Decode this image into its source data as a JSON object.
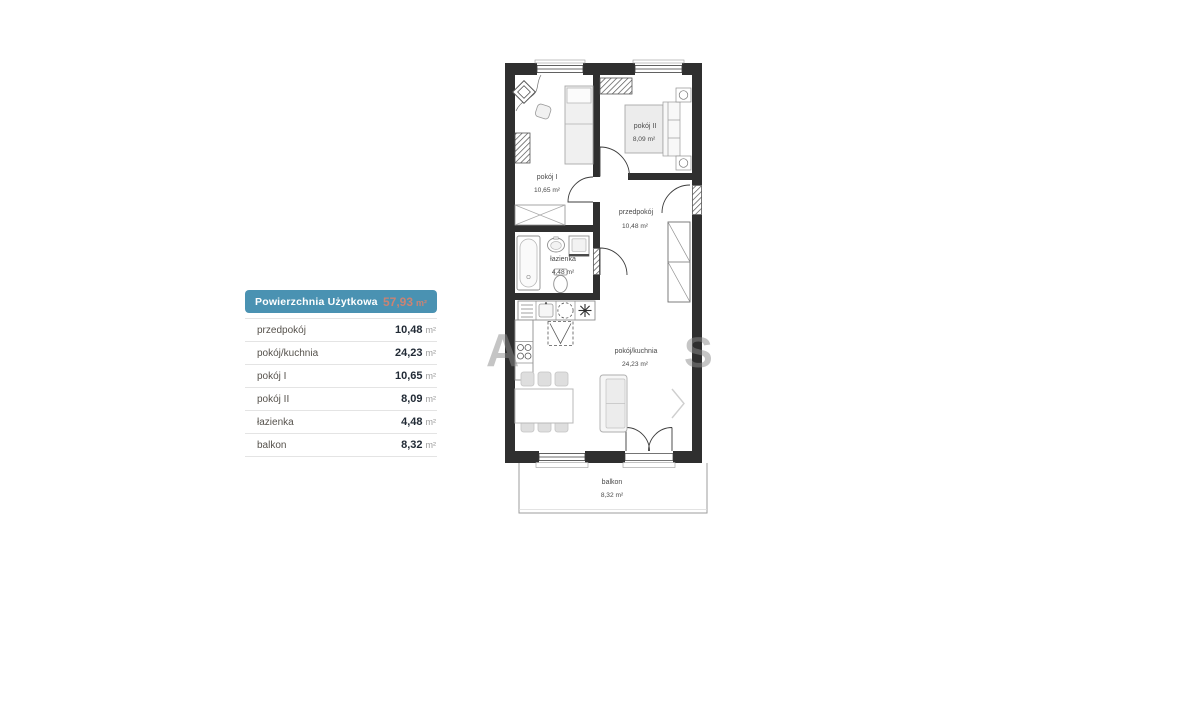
{
  "legend": {
    "title": "Powierzchnia Użytkowa",
    "total_value": "57,93",
    "total_unit": "m²",
    "rows": [
      {
        "label": "przedpokój",
        "value": "10,48",
        "unit": "m²"
      },
      {
        "label": "pokój/kuchnia",
        "value": "24,23",
        "unit": "m²"
      },
      {
        "label": "pokój I",
        "value": "10,65",
        "unit": "m²"
      },
      {
        "label": "pokój II",
        "value": "8,09",
        "unit": "m²"
      },
      {
        "label": "łazienka",
        "value": "4,48",
        "unit": "m²"
      },
      {
        "label": "balkon",
        "value": "8,32",
        "unit": "m²"
      }
    ]
  },
  "floorplan": {
    "rooms": [
      {
        "name": "pokój I",
        "area": "10,65 m²"
      },
      {
        "name": "pokój II",
        "area": "8,09 m²"
      },
      {
        "name": "przedpokój",
        "area": "10,48 m²"
      },
      {
        "name": "łazienka",
        "area": "4,48 m²"
      },
      {
        "name": "pokój/kuchnia",
        "area": "24,23 m²"
      },
      {
        "name": "balkon",
        "area": "8,32 m²"
      }
    ],
    "watermark": {
      "left_letter": "A",
      "right_letter": "S"
    }
  },
  "colors": {
    "header_bg": "#4a92b2",
    "header_text": "#ffffff",
    "header_value": "#cb8373",
    "wall": "#2f2f2f",
    "divider": "#e4e4e4",
    "row_label": "#56524c",
    "row_value": "#222b36",
    "unit": "#9c9c9c"
  }
}
